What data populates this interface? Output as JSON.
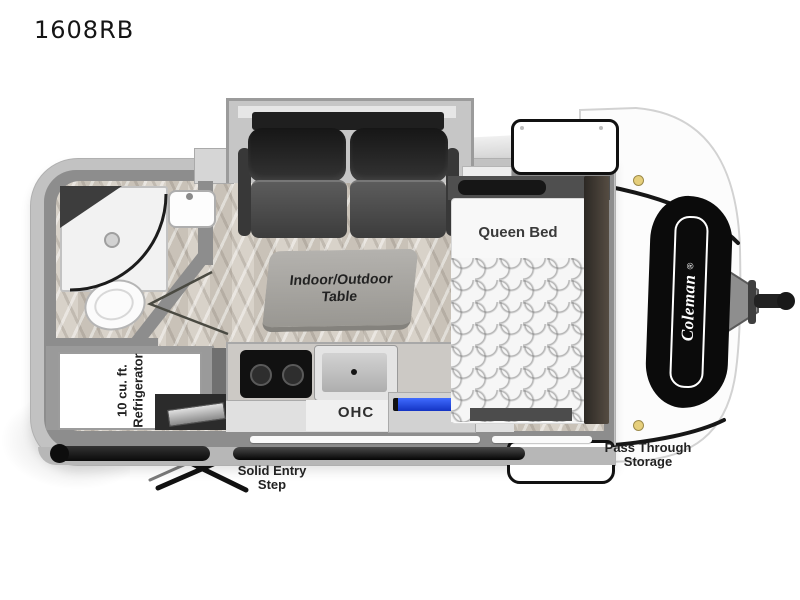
{
  "page": {
    "title": "1608RB"
  },
  "floorplan": {
    "brand": {
      "name": "Coleman",
      "mark": "®"
    },
    "labels": {
      "queen_bed": "Queen Bed",
      "table_line1": "Indoor/Outdoor",
      "table_line2": "Table",
      "ohc": "OHC",
      "fridge_line1": "10 cu. ft.",
      "fridge_line2": "Refrigerator",
      "pass_through_line1": "Pass Through",
      "pass_through_line2": "Storage",
      "entry_step_line1": "Solid Entry",
      "entry_step_line2": "Step"
    },
    "fixtures": [
      "shower",
      "toilet",
      "bathroom-sink",
      "refrigerator",
      "sofa",
      "indoor-outdoor-table",
      "cooktop",
      "kitchen-sink",
      "overhead-cabinet",
      "queen-bed",
      "wardrobe",
      "entry-step",
      "pass-through-storage",
      "hitch",
      "bumper",
      "awning-rail",
      "window",
      "clearance-light"
    ],
    "colors": {
      "accent_blue": "#2956d8",
      "body_gray": "#c2c2c2",
      "wall_gray": "#8d8d8d",
      "floor_tan": "#d3ccc3",
      "logo_black": "#0b0b0b"
    }
  }
}
